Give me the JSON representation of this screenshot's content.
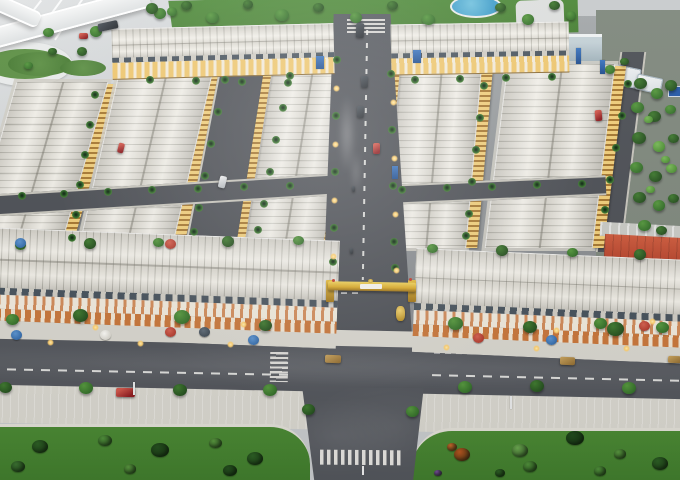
{
  "scene": {
    "title": "Aerial photo of a real-estate township scale model with shophouse rows, central boulevard, entrance gate, flyover and landscaped roads",
    "regions": {
      "flyover": {
        "label": "Curved elevated highway with loop ramp"
      },
      "park": {
        "label": "Green park strip with blue pond"
      },
      "shophouses": {
        "label": "Rows of white-roofed model shophouses with lit facades"
      },
      "boulevard": {
        "label": "Central boulevard with dashed centerline, palms and lamps"
      },
      "gate": {
        "label": "Golden project entrance gate (sign text illegible)"
      },
      "main_road": {
        "label": "Wide front road with crosswalks and model cars"
      },
      "lawns": {
        "label": "Front lawns with shrubs"
      },
      "forest": {
        "label": "Dense tree cluster on right edge"
      },
      "red_building": {
        "label": "Red-roofed long building, rear right"
      }
    }
  },
  "palette": {
    "base": "#c7cacc",
    "ground": "#8f9396",
    "asphalt": "#53565c",
    "asphaltDark": "#4c4f55",
    "sidewalk": "#d8d6ce",
    "lawn": "#4a8833",
    "lawnDark": "#3f7a2c",
    "park": "#4e8a39",
    "pond": "#3f9dc9",
    "roof": "#ece9e0",
    "roofLine": "#bebcb2",
    "facadeGold": "#f0cd79",
    "shopOrange": "#c8763a",
    "corniceSlate": "#47525c",
    "gateGold": "#d9a929",
    "flyover": "#eef0f0",
    "redRoof": "#b5432c",
    "forestBase": "#7e877c"
  },
  "objects": {
    "trees": [
      [
        160,
        14,
        12,
        "mid"
      ],
      [
        186,
        6,
        11,
        "dark"
      ],
      [
        212,
        18,
        13,
        "mid"
      ],
      [
        248,
        5,
        10,
        "dark"
      ],
      [
        282,
        16,
        14,
        "mid"
      ],
      [
        318,
        8,
        11,
        "dark"
      ],
      [
        356,
        18,
        12,
        "mid"
      ],
      [
        392,
        6,
        11,
        "dark"
      ],
      [
        428,
        20,
        13,
        "mid"
      ],
      [
        500,
        8,
        11,
        "dark"
      ],
      [
        528,
        20,
        12,
        "mid"
      ],
      [
        554,
        6,
        11,
        "dark"
      ],
      [
        571,
        16,
        10,
        "mid"
      ],
      [
        48,
        33,
        11,
        "mid"
      ],
      [
        96,
        32,
        12,
        "mid"
      ],
      [
        82,
        52,
        10,
        "dark"
      ],
      [
        52,
        52,
        9,
        "dark"
      ],
      [
        152,
        9,
        12,
        "dark"
      ],
      [
        172,
        12,
        10,
        "mid"
      ],
      [
        28,
        66,
        9,
        "mid"
      ],
      [
        20,
        246,
        11,
        "mid"
      ],
      [
        90,
        244,
        12,
        "dark"
      ],
      [
        158,
        243,
        11,
        "mid"
      ],
      [
        228,
        242,
        12,
        "dark"
      ],
      [
        298,
        241,
        11,
        "mid"
      ],
      [
        432,
        249,
        11,
        "mid"
      ],
      [
        502,
        251,
        12,
        "dark"
      ],
      [
        572,
        253,
        11,
        "mid"
      ],
      [
        640,
        255,
        12,
        "dark"
      ],
      [
        12,
        320,
        13,
        "mid"
      ],
      [
        80,
        316,
        15,
        "dark"
      ],
      [
        182,
        318,
        16,
        "mid"
      ],
      [
        265,
        326,
        13,
        "dark"
      ],
      [
        455,
        324,
        15,
        "mid"
      ],
      [
        530,
        328,
        14,
        "dark"
      ],
      [
        600,
        324,
        13,
        "mid"
      ],
      [
        615,
        330,
        17,
        "dark"
      ],
      [
        662,
        328,
        13,
        "mid"
      ],
      [
        5,
        388,
        13,
        "dark"
      ],
      [
        86,
        389,
        14,
        "mid"
      ],
      [
        180,
        391,
        14,
        "dark"
      ],
      [
        270,
        391,
        14,
        "mid"
      ],
      [
        308,
        410,
        13,
        "dark"
      ],
      [
        412,
        412,
        13,
        "mid"
      ],
      [
        465,
        388,
        14,
        "mid"
      ],
      [
        537,
        387,
        14,
        "dark"
      ],
      [
        629,
        389,
        14,
        "mid"
      ],
      [
        640,
        84,
        13,
        "dark"
      ],
      [
        657,
        94,
        12,
        "mid"
      ],
      [
        671,
        86,
        12,
        "dark"
      ],
      [
        637,
        108,
        13,
        "mid"
      ],
      [
        654,
        117,
        13,
        "dark"
      ],
      [
        670,
        110,
        11,
        "mid"
      ],
      [
        639,
        139,
        14,
        "dark"
      ],
      [
        659,
        147,
        12,
        "light"
      ],
      [
        673,
        139,
        11,
        "dark"
      ],
      [
        636,
        168,
        13,
        "mid"
      ],
      [
        655,
        177,
        13,
        "dark"
      ],
      [
        671,
        169,
        11,
        "light"
      ],
      [
        639,
        198,
        13,
        "dark"
      ],
      [
        659,
        206,
        12,
        "mid"
      ],
      [
        673,
        199,
        11,
        "dark"
      ],
      [
        644,
        226,
        13,
        "mid"
      ],
      [
        661,
        231,
        11,
        "dark"
      ],
      [
        648,
        120,
        9,
        "light"
      ],
      [
        665,
        160,
        9,
        "light"
      ],
      [
        650,
        190,
        9,
        "light"
      ],
      [
        610,
        70,
        10,
        "mid"
      ],
      [
        624,
        62,
        9,
        "dark"
      ]
    ],
    "palms": [
      [
        337,
        60
      ],
      [
        336,
        116
      ],
      [
        335,
        172
      ],
      [
        334,
        228
      ],
      [
        333,
        262
      ],
      [
        391,
        74
      ],
      [
        392,
        130
      ],
      [
        393,
        186
      ],
      [
        394,
        242
      ],
      [
        395,
        268
      ],
      [
        95,
        95
      ],
      [
        90,
        125
      ],
      [
        85,
        155
      ],
      [
        80,
        185
      ],
      [
        76,
        215
      ],
      [
        72,
        238
      ],
      [
        225,
        80
      ],
      [
        218,
        112
      ],
      [
        211,
        144
      ],
      [
        205,
        176
      ],
      [
        199,
        208
      ],
      [
        194,
        232
      ],
      [
        290,
        76
      ],
      [
        283,
        108
      ],
      [
        276,
        140
      ],
      [
        270,
        172
      ],
      [
        264,
        204
      ],
      [
        258,
        230
      ],
      [
        484,
        86
      ],
      [
        480,
        118
      ],
      [
        476,
        150
      ],
      [
        472,
        182
      ],
      [
        469,
        214
      ],
      [
        466,
        236
      ],
      [
        628,
        84
      ],
      [
        622,
        116
      ],
      [
        616,
        148
      ],
      [
        610,
        180
      ],
      [
        605,
        210
      ],
      [
        150,
        80
      ],
      [
        196,
        81
      ],
      [
        242,
        82
      ],
      [
        288,
        83
      ],
      [
        415,
        80
      ],
      [
        460,
        79
      ],
      [
        506,
        78
      ],
      [
        552,
        77
      ],
      [
        22,
        196
      ],
      [
        64,
        194
      ],
      [
        108,
        192
      ],
      [
        152,
        190
      ],
      [
        198,
        189
      ],
      [
        244,
        187
      ],
      [
        290,
        186
      ],
      [
        402,
        190
      ],
      [
        447,
        188
      ],
      [
        492,
        187
      ],
      [
        537,
        185
      ],
      [
        582,
        184
      ]
    ],
    "umbrellas": [
      [
        16,
        334,
        "blue"
      ],
      [
        105,
        334,
        "white"
      ],
      [
        170,
        331,
        "red"
      ],
      [
        204,
        331,
        "slate"
      ],
      [
        253,
        339,
        "blue"
      ],
      [
        478,
        337,
        "red"
      ],
      [
        551,
        339,
        "blue"
      ],
      [
        644,
        325,
        "red"
      ],
      [
        20,
        242,
        "blue"
      ],
      [
        170,
        243,
        "red"
      ]
    ],
    "cars": [
      [
        356,
        23,
        8,
        15,
        "dark",
        2
      ],
      [
        98,
        22,
        20,
        8,
        "dark",
        -12
      ],
      [
        79,
        33,
        9,
        6,
        "red",
        0
      ],
      [
        361,
        76,
        7,
        12,
        "dark",
        1
      ],
      [
        357,
        106,
        7,
        12,
        "dark",
        3
      ],
      [
        373,
        143,
        7,
        11,
        "red",
        0
      ],
      [
        219,
        176,
        7,
        12,
        "white",
        14
      ],
      [
        595,
        110,
        7,
        11,
        "red",
        -5
      ],
      [
        118,
        143,
        6,
        10,
        "red",
        14
      ],
      [
        352,
        186,
        3,
        6,
        "dark",
        0
      ],
      [
        350,
        248,
        3,
        6,
        "dark",
        0
      ],
      [
        325,
        355,
        16,
        8,
        "tan",
        2
      ],
      [
        560,
        357,
        15,
        8,
        "tan",
        2
      ],
      [
        668,
        356,
        13,
        7,
        "tan",
        2
      ],
      [
        116,
        388,
        19,
        9,
        "red",
        1
      ]
    ],
    "lamps": [
      [
        336,
        88
      ],
      [
        335,
        144
      ],
      [
        334,
        200
      ],
      [
        333,
        256
      ],
      [
        393,
        102
      ],
      [
        394,
        158
      ],
      [
        395,
        214
      ],
      [
        396,
        270
      ],
      [
        50,
        342
      ],
      [
        140,
        343
      ],
      [
        230,
        344
      ],
      [
        446,
        347
      ],
      [
        536,
        348
      ],
      [
        626,
        348
      ],
      [
        95,
        327
      ],
      [
        243,
        324
      ],
      [
        556,
        330
      ],
      [
        652,
        321
      ]
    ],
    "poles": [
      [
        133,
        382
      ],
      [
        510,
        396
      ]
    ],
    "bushes": [
      [
        40,
        448,
        16,
        "#2c5e24"
      ],
      [
        105,
        442,
        14,
        "#4f8f3a"
      ],
      [
        160,
        452,
        18,
        "#244f1e"
      ],
      [
        215,
        444,
        13,
        "#57953e"
      ],
      [
        255,
        460,
        16,
        "#2c5e24"
      ],
      [
        18,
        468,
        14,
        "#3a7030"
      ],
      [
        130,
        470,
        12,
        "#57953e"
      ],
      [
        230,
        472,
        14,
        "#244f1e"
      ],
      [
        462,
        456,
        16,
        "#b5541f"
      ],
      [
        452,
        448,
        10,
        "#c4662a"
      ],
      [
        520,
        452,
        16,
        "#6aa84f"
      ],
      [
        530,
        468,
        14,
        "#4f8f3a"
      ],
      [
        575,
        440,
        18,
        "#1f4a1c"
      ],
      [
        620,
        455,
        12,
        "#57953e"
      ],
      [
        660,
        465,
        16,
        "#2c5e24"
      ],
      [
        600,
        472,
        12,
        "#4f8f3a"
      ],
      [
        500,
        474,
        10,
        "#2c5e24"
      ],
      [
        438,
        474,
        8,
        "#7a4f9e"
      ]
    ],
    "banners": [
      [
        316,
        56,
        8,
        13
      ],
      [
        413,
        50,
        8,
        13
      ],
      [
        392,
        166,
        6,
        13
      ],
      [
        576,
        48,
        5,
        16
      ],
      [
        600,
        60,
        5,
        14
      ]
    ]
  }
}
